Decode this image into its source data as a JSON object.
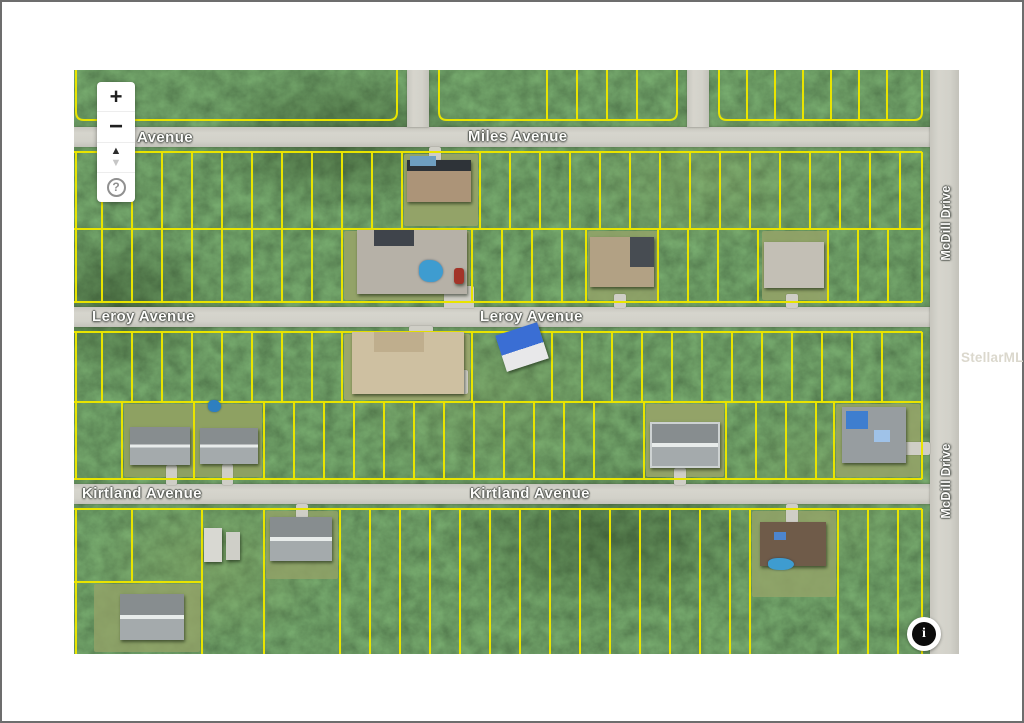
{
  "watermark": {
    "text": "StellarMLS"
  },
  "map": {
    "controls": {
      "zoom_in_label": "+",
      "zoom_out_label": "−",
      "pan_up_label": "▲",
      "pan_down_label": "▼",
      "help_label": "?"
    },
    "info_button_label": "i",
    "streets": {
      "top_left_partial": "Avenue",
      "miles": "Miles Avenue",
      "leroy_left": "Leroy Avenue",
      "leroy_center": "Leroy Avenue",
      "kirtland_left": "Kirtland Avenue",
      "kirtland_center": "Kirtland Avenue",
      "mcdill_upper": "McDill Drive",
      "mcdill_lower": "McDill Drive"
    },
    "colors": {
      "parcel_line": "#e9e400",
      "road": "#d2d1c9",
      "forest": "#33491f",
      "street_label": "#fdfdfb"
    }
  }
}
